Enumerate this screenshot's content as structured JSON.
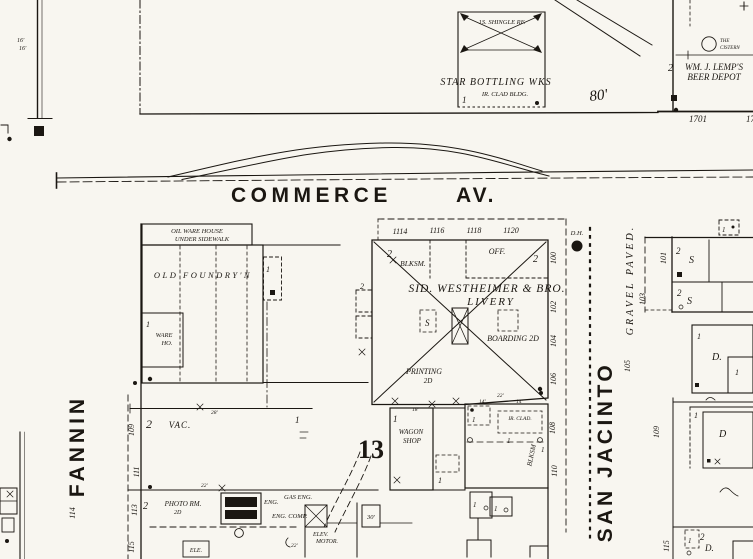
{
  "page": {
    "bg": "#f8f6f0",
    "ink": "#1b1712"
  },
  "streets": {
    "commerce": "COMMERCE",
    "commerce_av": "AV.",
    "fannin": "FANNIN",
    "san_jacinto": "SAN JACINTO",
    "gravel_paved": "GRAVEL PAVED.",
    "block_number": "13"
  },
  "top_left": {
    "dim_a": "16'",
    "dim_b": "16'"
  },
  "top_block": {
    "roof_note": "1S. SHINGLE RF.",
    "name": "STAR BOTTLING WKS",
    "construction": "IR. CLAD BLDG.",
    "story": "1",
    "dim": "80'"
  },
  "lemp": {
    "story": "2",
    "name_line1": "WM. J. LEMP'S",
    "name_line2": "BEER DEPOT",
    "cistern_line1": "THE",
    "cistern_line2": "CISTERN",
    "addr_1701": "1701",
    "addr_17": "17"
  },
  "oil_house": {
    "line1": "OIL WARE HOUSE",
    "line2": "UNDER SIDEWALK"
  },
  "foundry": {
    "name": "OLD FOUNDRY'N",
    "ware_story": "1",
    "ware_line1": "WARE",
    "ware_line2": "HO.",
    "shed_story": "1"
  },
  "vac": {
    "story": "2",
    "label": "VAC.",
    "dim": "28'",
    "right_story": "1"
  },
  "photo": {
    "story": "2",
    "name": "PHOTO RM.",
    "floor": "2D",
    "dim": "22'"
  },
  "power": {
    "eng": "ENG.",
    "gas_eng": "GAS ENG.",
    "eng_comp": "ENG. COMP.",
    "elev_line1": "ELEV.",
    "elev_line2": "MOTOR.",
    "dim22": "22'",
    "dim30": "30'",
    "ele": "ELE."
  },
  "livery": {
    "addresses": [
      "1114",
      "1116",
      "1118",
      "1120"
    ],
    "blksm_story": "2",
    "blksm": "BLKSM.",
    "office": "OFF.",
    "office_story": "2",
    "name_line1": "SID. WESTHEIMER & BRO.",
    "name_line2": "LIVERY",
    "stable": "S",
    "boarding": "BOARDING 2D",
    "printing_line1": "PRINTING",
    "printing_line2": "2D",
    "side_addresses": [
      "100",
      "102",
      "104",
      "106",
      "108",
      "110"
    ],
    "left_story": "2",
    "dims": [
      "18'",
      "14'",
      "22'",
      "14'"
    ]
  },
  "wagon": {
    "story": "1",
    "line1": "WAGON",
    "line2": "SHOP",
    "annex": "1"
  },
  "smith": {
    "label": "IR. CLAD.",
    "blksm": "BLKSM",
    "shed": "1",
    "a": "1",
    "b": "1",
    "c": "1",
    "d": "1"
  },
  "hydrant": {
    "label": "D.H."
  },
  "fannin_side": {
    "addresses": [
      "109",
      "111",
      "113",
      "115"
    ],
    "west_address": "114"
  },
  "east_block": {
    "r1_story": "2",
    "r1_type": "S",
    "r1_addr": "101",
    "r2_story": "2",
    "r2_type": "S",
    "r2_addr": "103",
    "shed": "1",
    "r3_story": "1",
    "r3_type": "D.",
    "r3_inner": "1",
    "r3_addr": "105",
    "r4_story": "1",
    "r4_type": "D",
    "r4_addr": "109",
    "r5_story_a": "1",
    "r5_story_b": "2",
    "r5_type": "D.",
    "r5_addr": "115"
  }
}
